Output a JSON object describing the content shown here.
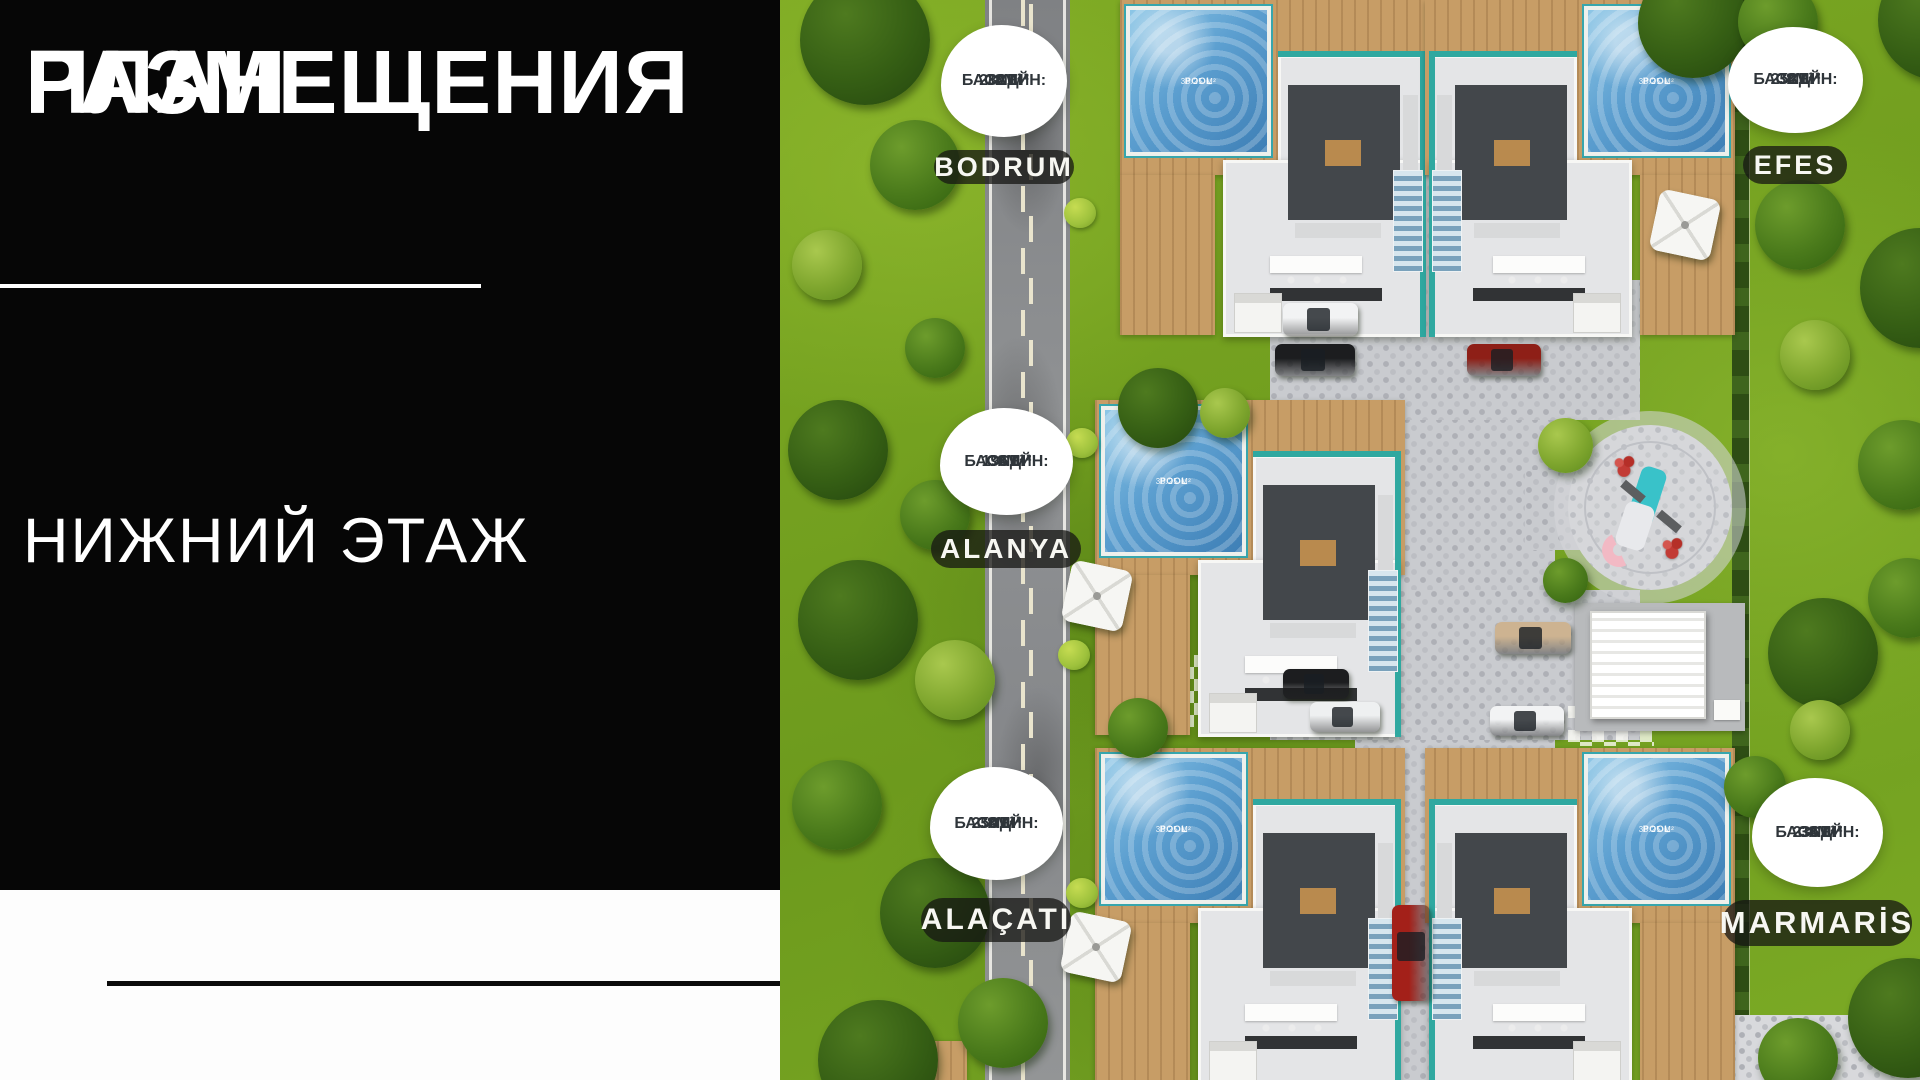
{
  "left_panel": {
    "title_line1": "ПЛАН",
    "title_line2": "РАЗМЕЩЕНИЯ",
    "subtitle": "НИЖНИЙ ЭТАЖ"
  },
  "villas": [
    {
      "name": "BODRUM",
      "garden_label": "САД:",
      "garden_area": "282 М²",
      "pool_label": "БАССЕЙН:",
      "pool_area": "38М²"
    },
    {
      "name": "EFES",
      "garden_label": "САД:",
      "garden_area": "252 М²",
      "pool_label": "БАССЕЙН:",
      "pool_area": "38М²"
    },
    {
      "name": "ALANYA",
      "garden_label": "САД:",
      "garden_area": "196 М²",
      "pool_label": "БАССЕЙН:",
      "pool_area": "38М²"
    },
    {
      "name": "ALAÇATI",
      "garden_label": "САД:",
      "garden_area": "250 М²",
      "pool_label": "БАССЕЙН:",
      "pool_area": "38М²"
    },
    {
      "name": "MARMARİS",
      "garden_label": "САД:",
      "garden_area": "236 М²",
      "pool_label": "БАССЕЙН:",
      "pool_area": "38М²"
    }
  ],
  "site_plan": {
    "pool_caption_line1": "POOL",
    "pool_caption_line2": "38.25 M²"
  },
  "colors": {
    "panel_black": "#060606",
    "accent_teal": "#2fa8a0",
    "grass_green": "#7aa822",
    "badge_text": "#2f353a"
  }
}
